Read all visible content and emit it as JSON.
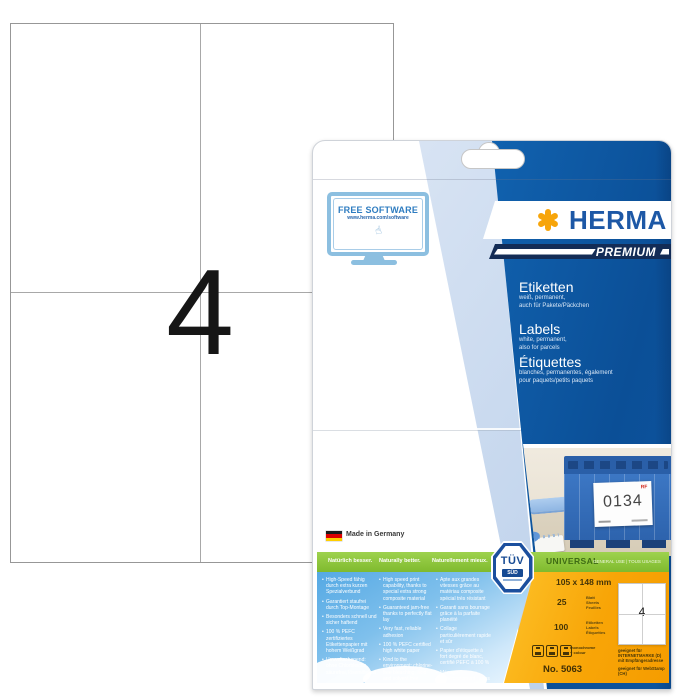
{
  "sheet": {
    "label_count": "4"
  },
  "package": {
    "free_software": {
      "title": "FREE SOFTWARE",
      "url": "www.herma.com/software"
    },
    "brand": {
      "name": "HERMA",
      "tier": "PREMIUM"
    },
    "product": {
      "de": {
        "title": "Etiketten",
        "line1": "weiß, permanent,",
        "line2": "auch für Pakete/Päckchen"
      },
      "en": {
        "title": "Labels",
        "line1": "white, permanent,",
        "line2": "also for parcels"
      },
      "fr": {
        "title": "Étiquettes",
        "line1": "blanches, permanentes, également",
        "line2": "pour paquets/petits paquets"
      }
    },
    "photo": {
      "crate_label": "0134",
      "corner_mark": "RF"
    },
    "made_in": "Made in Germany",
    "tuv": {
      "line1": "TÜV",
      "line2": "SÜD"
    },
    "green_bar": {
      "de": "Natürlich besser.",
      "en": "Naturally better.",
      "fr": "Naturellement mieux."
    },
    "universal": {
      "title": "UNIVERSAL",
      "subtitle": "GENERAL USE | TOUS USAGES"
    },
    "features": {
      "de": [
        "High-Speed fähig durch extra kurzen Spezialverbund",
        "Garantiert staufrei durch Top-Montage",
        "Besonders schnell und sicher haftend",
        "100 % PEFC zertifiziertes Etikettenpapier mit hohem Weißgrad",
        "Umweltschonend: ohne Chlorbleiche, säurefrei, lösemittelfrei"
      ],
      "en": [
        "High speed print capability, thanks to special extra strong composite material",
        "Guaranteed jam-free thanks to perfectly flat lay",
        "Very fast, reliable adhesion",
        "100 % PEFC certified high white paper",
        "Kind to the environment: chlorine-free bleaching, acid and solvent free"
      ],
      "fr": [
        "Apte aux grandes vitesses grâce au matériau composite spécial très résistant",
        "Garanti sans bourrage grâce à la parfaite planéité",
        "Collage particulièrement rapide et sûr",
        "Papier d'étiquette à fort degré de blanc, certifié PEFC à 100 %",
        "Ménage l'environnement : sans chlore, sans acide, ni solvant"
      ]
    },
    "specs": {
      "size": "105 x 148 mm",
      "sheets_count": "25",
      "sheets_units": [
        "Blatt",
        "Sheets",
        "Feuilles"
      ],
      "labels_count": "100",
      "labels_units": [
        "Etiketten",
        "Labels",
        "Étiquettes"
      ],
      "print_note": "monochrome + colour",
      "item_no": "No. 5063",
      "mini_label_count": "4",
      "suitable_de": "geeignet für INTERNETMARKE (D) mit Empfängeradresse",
      "suitable_ch": "geeignet für WebStamp (CH)"
    }
  },
  "colors": {
    "brand_blue": "#1d58a6",
    "panel_blue": "#0e5aa6",
    "accent_orange": "#f7a50a",
    "green": "#8dc63f",
    "spec_orange": "#f8a507",
    "sky": "#7fc0ec",
    "premium_navy": "#132c56"
  }
}
